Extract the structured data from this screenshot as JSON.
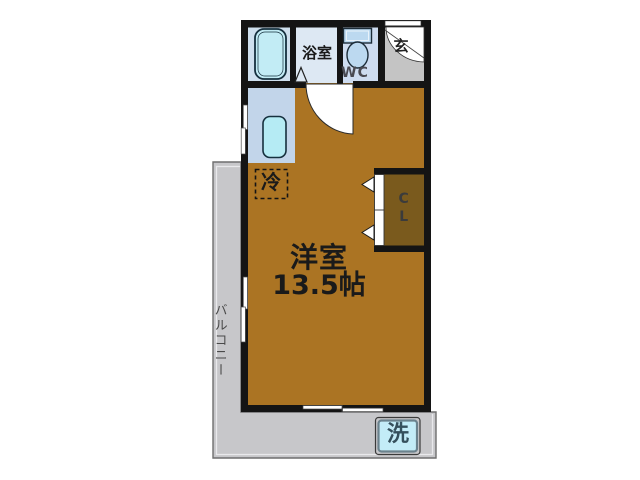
{
  "plan": {
    "main_room": {
      "label": "洋室",
      "size": "13.5帖"
    },
    "bathroom": {
      "label": "浴室"
    },
    "toilet": {
      "label": "WC"
    },
    "entrance": {
      "label": "玄"
    },
    "refrigerator": {
      "label": "冷"
    },
    "closet": {
      "label": "CL"
    },
    "balcony": {
      "label": "バルコニー"
    },
    "washer": {
      "label": "洗"
    }
  },
  "icons": [
    "bathtub-icon",
    "toilet-icon",
    "kitchen-sink-icon",
    "washing-machine-icon",
    "door-swing-arc-icon",
    "folding-door-icon",
    "sliding-window-icon"
  ],
  "colors": {
    "wall": "#141414",
    "room": "#ab7423",
    "closet": "#7a5a1d",
    "bathroom": "#dde8f3",
    "bath_stall": "#cfe0ee",
    "wc_floor": "#cedcf0",
    "kitchen": "#c2d5ea",
    "entrance": "#c4c4c4",
    "balcony": "#c7c7ca",
    "tub": "#c2ecf5",
    "sink": "#b5ebf4",
    "toilet": "#bcd9f0",
    "washer": "#c3ecf7",
    "door_white": "#ffffff"
  }
}
